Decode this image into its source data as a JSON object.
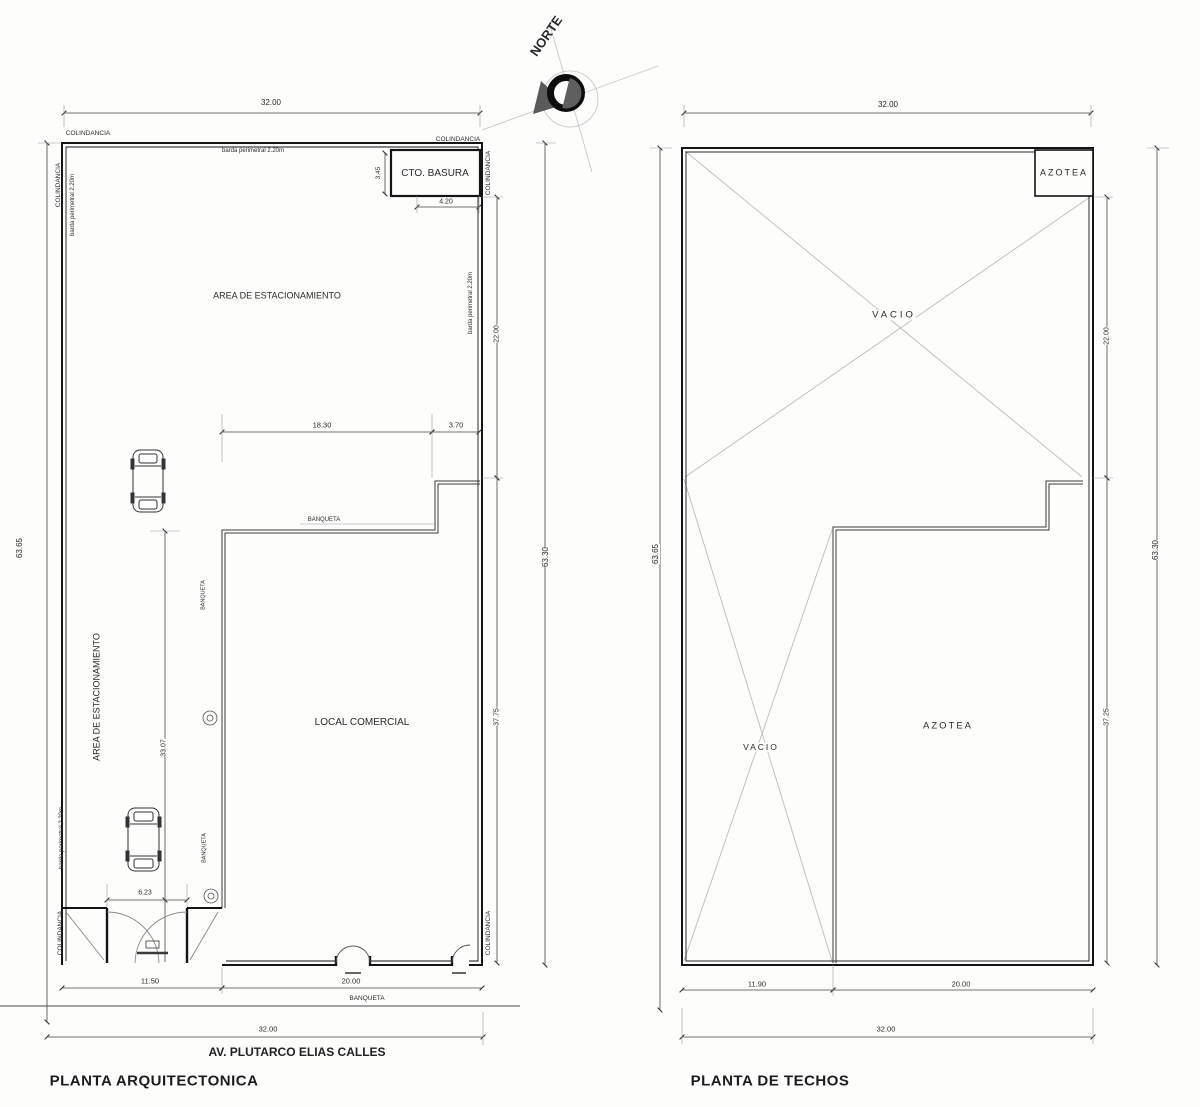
{
  "shared": {
    "colindancia": "COLINDANCIA",
    "barda": "barda perimetral 2.20m",
    "banqueta": "BANQUETA",
    "vacio": "VACIO",
    "azotea": "AZOTEA"
  },
  "compass": {
    "north": "NORTE"
  },
  "plan_left": {
    "title": "PLANTA ARQUITECTONICA",
    "street": "AV. PLUTARCO ELIAS CALLES",
    "area_estacionamiento": "AREA DE ESTACIONAMIENTO",
    "local_comercial": "LOCAL COMERCIAL",
    "cto_basura": "CTO. BASURA",
    "dims": {
      "width_top": "32.00",
      "height_left": "63.65",
      "height_right": "63.30",
      "upper_right": "22.00",
      "lower_right": "37.75",
      "basura_width": "4.20",
      "basura_height": "3.45",
      "front_left": "18.30",
      "front_right": "3.70",
      "drive_depth": "33.07",
      "gate_width": "6.23",
      "bottom_left": "11.50",
      "bottom_right": "20.00",
      "width_bottom": "32.00"
    }
  },
  "plan_right": {
    "title": "PLANTA DE TECHOS",
    "dims": {
      "width_top": "32.00",
      "height_left": "63.65",
      "height_right": "63.30",
      "upper_right": "22.00",
      "lower_right": "37.25",
      "bottom_left": "11.90",
      "bottom_right": "20.00",
      "width_bottom": "32.00"
    }
  }
}
